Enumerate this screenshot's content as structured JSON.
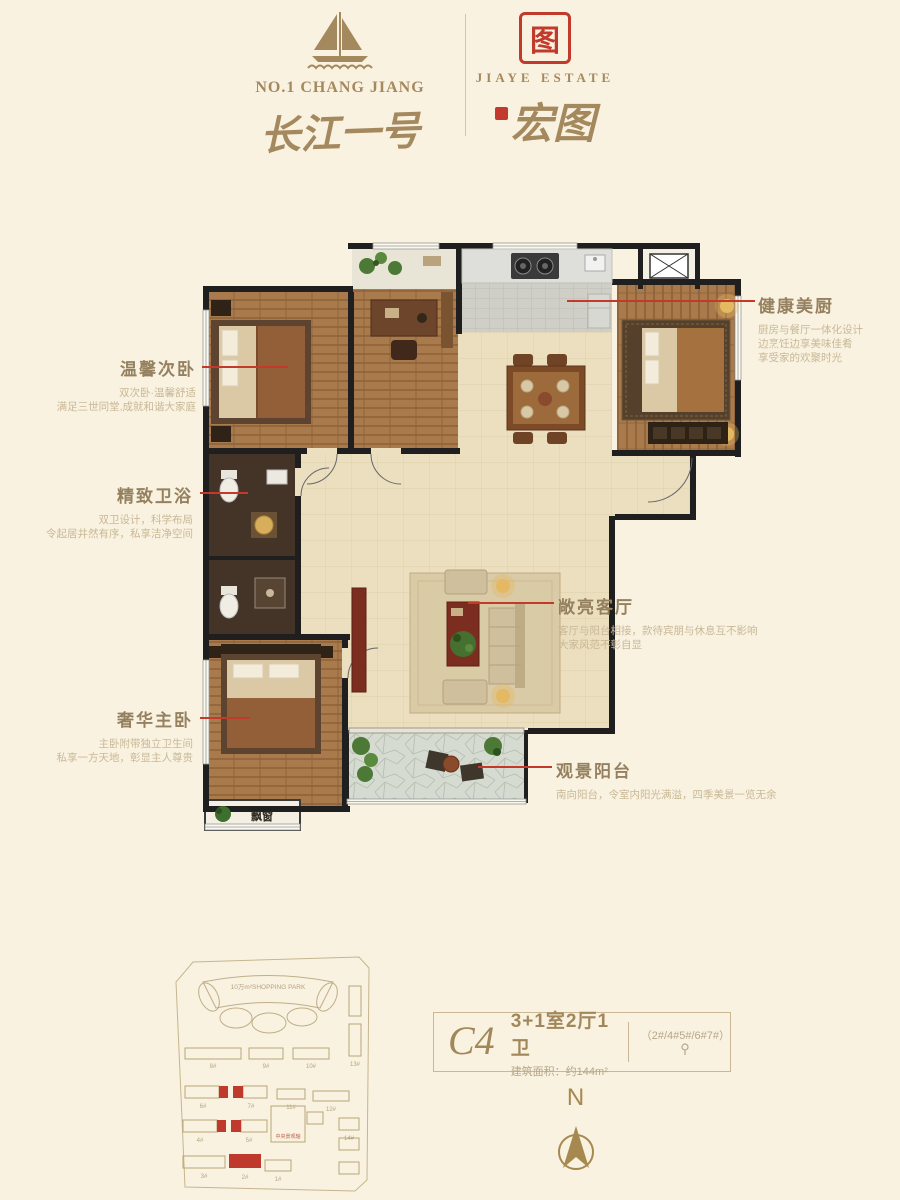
{
  "colors": {
    "accent_red": "#c23a2c",
    "gold": "#a5895e",
    "cream": "#f9f2e1"
  },
  "header": {
    "left": {
      "en": "NO.1 CHANG JIANG",
      "cn": "长江一号"
    },
    "right": {
      "en": "JIAYE ESTATE",
      "cn": "宏图",
      "seal": "图"
    }
  },
  "annotations": {
    "bedroom2": {
      "title": "温馨次卧",
      "line1": "双次卧·温馨舒适",
      "line2": "满足三世同堂,成就和谐大家庭"
    },
    "bath": {
      "title": "精致卫浴",
      "line1": "双卫设计，科学布局",
      "line2": "令起居井然有序，私享洁净空间"
    },
    "master": {
      "title": "奢华主卧",
      "line1": "主卧附带独立卫生间",
      "line2": "私享一方天地，彰显主人尊贵"
    },
    "kitchen": {
      "title": "健康美厨",
      "line1": "厨房与餐厅一体化设计",
      "line2": "边烹饪边享美味佳肴",
      "line3": "享受家的欢聚时光"
    },
    "living": {
      "title": "敞亮客厅",
      "line1": "客厅与阳台相接，款待宾朋与休息互不影响",
      "line2": "大家风范不彰自显"
    },
    "balcony": {
      "title": "观景阳台",
      "line1": "南向阳台，令室内阳光满溢，四季美景一览无余"
    }
  },
  "floorplan": {
    "bay_window": "飘窗"
  },
  "siteplan": {
    "shopping_park": "10万m²SHOPPING PARK",
    "center_label": "中央景观轴",
    "b8": "8#",
    "b9": "9#",
    "b10": "10#",
    "b13": "13#",
    "b6": "6#",
    "b7": "7#",
    "b11": "11#",
    "b12": "12#",
    "b4": "4#",
    "b5": "5#",
    "b14": "14#",
    "b3": "3#",
    "b2": "2#",
    "b1": "1#"
  },
  "unit": {
    "code": "C4",
    "layout": "3+1室2厅1卫",
    "area": "建筑面积：约144m²",
    "note": "（2#/4#5#/6#7#）"
  },
  "compass": {
    "north": "N"
  }
}
